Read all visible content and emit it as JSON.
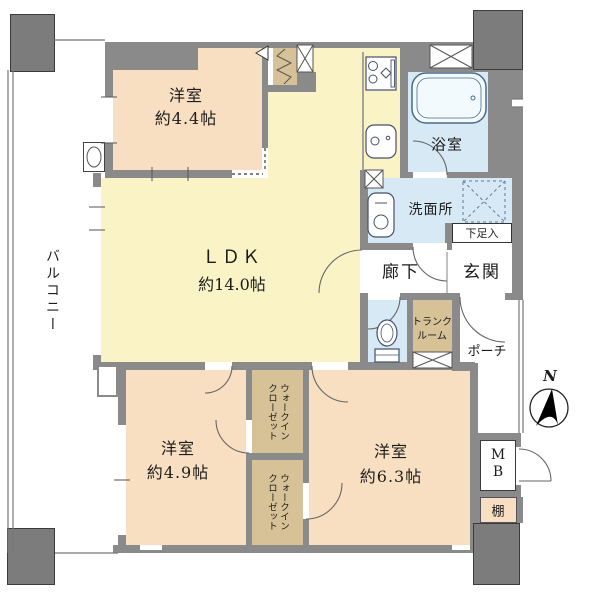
{
  "plan_title": "マンション間取り図",
  "colors": {
    "wall": "#8a8a8a",
    "room_peach": "#f8dfc2",
    "room_yellow": "#f9f3c6",
    "room_blue": "#d7e9f5",
    "closet_tan": "#d7c197",
    "fixture_line": "#4a6a8a"
  },
  "rooms": {
    "balcony": {
      "label": "バルコニー"
    },
    "bedroom_44": {
      "name": "洋室",
      "size": "約4.4帖"
    },
    "ldk": {
      "name": "ＬＤＫ",
      "size": "約14.0帖"
    },
    "bath": {
      "label": "浴室"
    },
    "washroom": {
      "label": "洗面所"
    },
    "shoe_cabinet": {
      "label": "下足入"
    },
    "entrance": {
      "label": "玄関"
    },
    "hallway": {
      "label": "廊下"
    },
    "trunk_room": {
      "line1": "トランク",
      "line2": "ルーム"
    },
    "porch": {
      "label": "ポーチ"
    },
    "bedroom_49": {
      "name": "洋室",
      "size": "約4.9帖"
    },
    "bedroom_63": {
      "name": "洋室",
      "size": "約6.3帖"
    },
    "wic_upper": {
      "line1": "ウォークイン",
      "line2": "クローゼット"
    },
    "wic_lower": {
      "line1": "ウォークイン",
      "line2": "クローゼット"
    },
    "meter_box": {
      "line1": "M",
      "line2": "B"
    },
    "shelf": {
      "label": "棚"
    },
    "compass": {
      "label": "N"
    }
  }
}
